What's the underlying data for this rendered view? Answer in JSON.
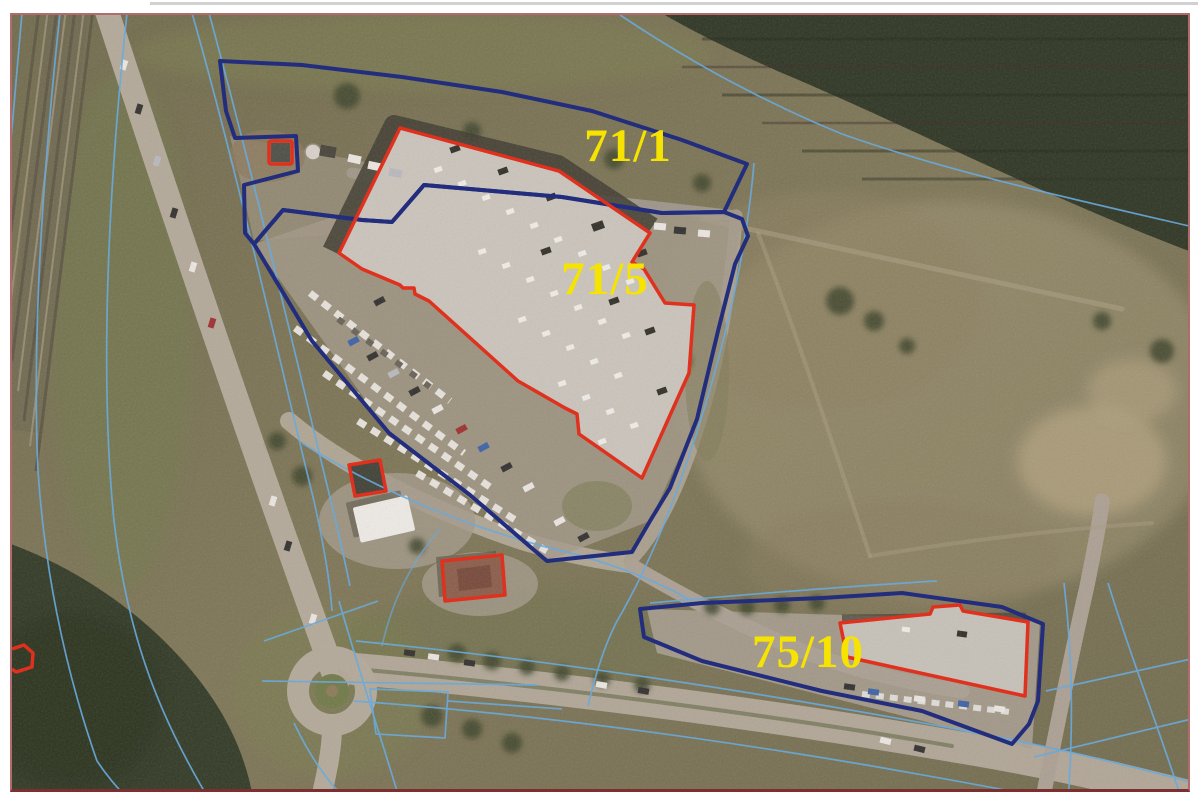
{
  "labels": {
    "parcel_71_1": "71/1",
    "parcel_71_5": "71/5",
    "parcel_75_10": "75/10"
  },
  "colors": {
    "parcel_boundary_navy": "#232d7d",
    "building_outline_red": "#e0301e",
    "cadastral_line_cyan": "#6aaadc",
    "parcel_label_yellow": "#f6e400",
    "frame_border": "#b36a6a",
    "frame_border_bottom": "#7d2f2f"
  }
}
